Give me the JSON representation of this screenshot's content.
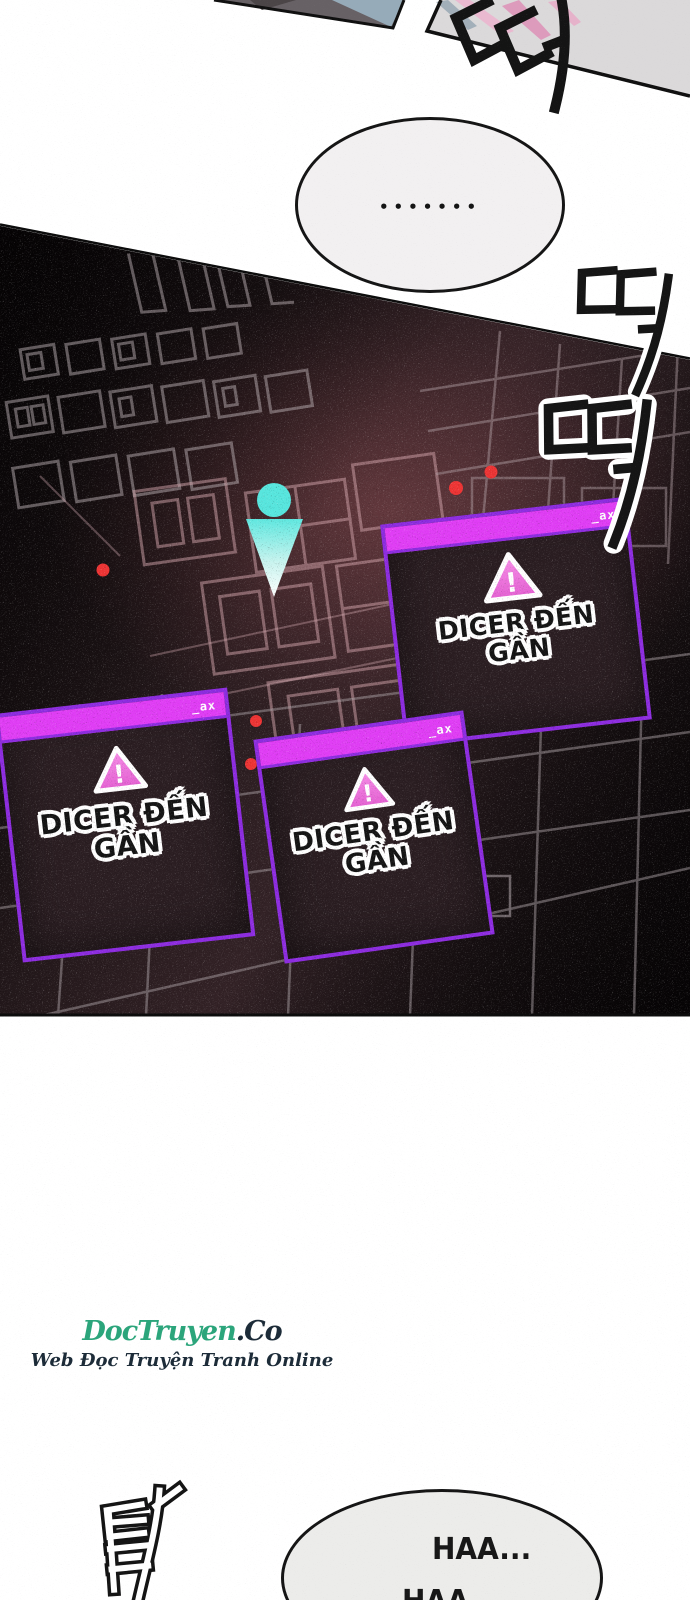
{
  "bubble_top": {
    "text": "•••••••"
  },
  "map_hud": {
    "alerts": [
      {
        "window_controls": "_ax",
        "triangle_mark": "!",
        "warning_line1": "DICER ĐẾN",
        "warning_line2": "GẦN"
      },
      {
        "window_controls": "_ax",
        "triangle_mark": "!",
        "warning_line1": "DICER ĐẾN",
        "warning_line2": "GẦN"
      },
      {
        "window_controls": "_ax",
        "triangle_mark": "!",
        "warning_line1": "DICER ĐẾN",
        "warning_line2": "GẦN"
      }
    ],
    "enemy_marker_count": 5,
    "colors": {
      "titlebar": "#e03df5",
      "window_border": "#8d2ce0",
      "warning_triangle": "#ee72d8",
      "player_marker": "#57e6de",
      "enemy_marker": "#ee3434"
    }
  },
  "sfx": {
    "beep_top": "띠",
    "beep_upper": "띠",
    "beep_lower": "띠",
    "thud_bottom": "탁"
  },
  "watermark": {
    "site_name": "DocTruyen",
    "site_suffix": ".Co",
    "tagline": "Web Đọc Truyện Tranh Online",
    "colors": {
      "site_name": "#2ba57b",
      "site_suffix": "#1c2b38"
    }
  },
  "bubble_bottom": {
    "line1": "HAA...",
    "line2": "HAA"
  }
}
